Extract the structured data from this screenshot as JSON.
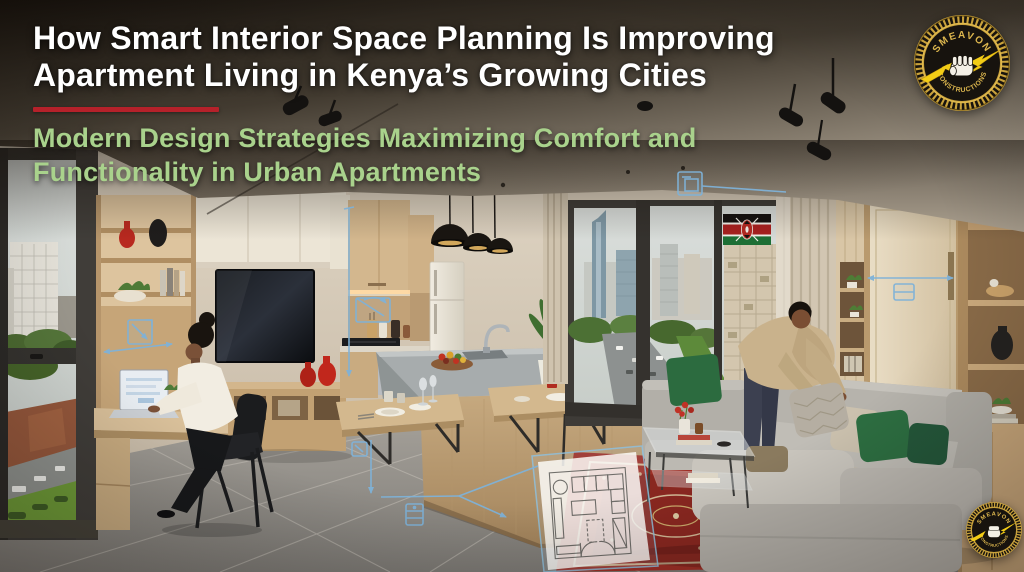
{
  "header": {
    "title_line1": "How Smart Interior Space Planning Is Improving",
    "title_line2": "Apartment Living in Kenya’s Growing Cities",
    "title_color": "#ffffff",
    "divider_color": "#b5212a",
    "subtitle_line1": "Modern Design Strategies Maximizing Comfort and",
    "subtitle_line2": "Functionality in Urban Apartments",
    "subtitle_color": "#a9d28c"
  },
  "brand_badge": {
    "arc_top": "SMEAVON",
    "arc_bottom": "CONSTRUCTIONS",
    "ring_color": "#c9a23c",
    "face_color": "#17130e",
    "text_color": "#dcb64e",
    "bolt_color": "#f2cc16",
    "fist_color": "#f4f0e6"
  },
  "flag": {
    "country": "Kenya",
    "black": "#14100e",
    "white": "#f2efe9",
    "red": "#a8201f",
    "green": "#1d6e34"
  },
  "annotations": {
    "accent_color": "#7fb2d8"
  }
}
